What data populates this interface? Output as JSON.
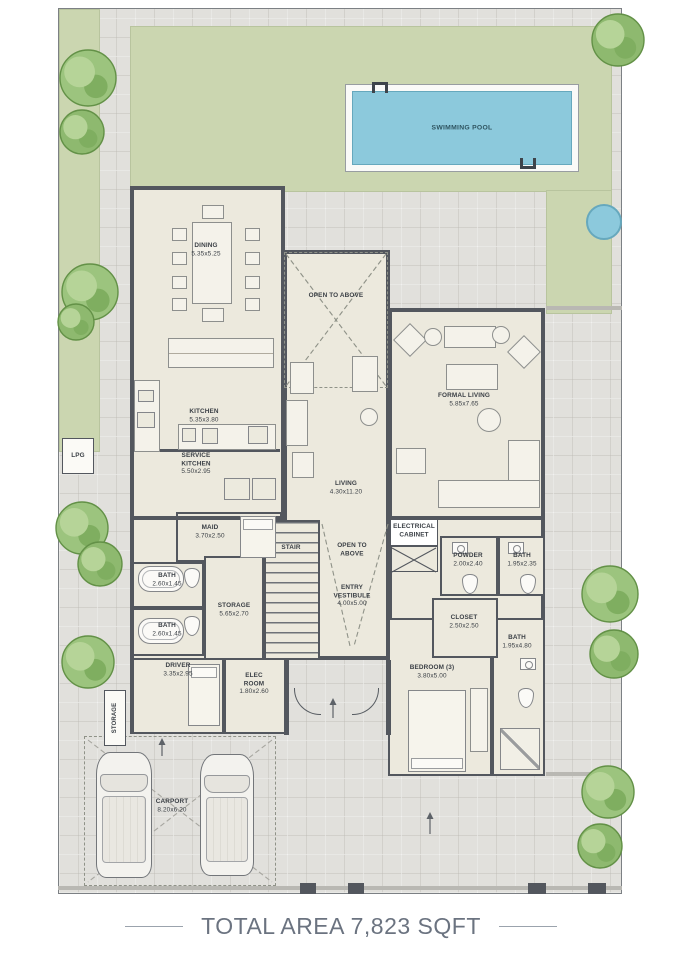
{
  "floorplan": {
    "pool_label": "SWIMMING POOL",
    "total_area_caption": "TOTAL AREA 7,823 SQFT",
    "rooms": [
      {
        "id": "dining",
        "name_lines": [
          "DINING"
        ],
        "dim": "5.35x5.25"
      },
      {
        "id": "kitchen",
        "name_lines": [
          "KITCHEN"
        ],
        "dim": "5.35x3.80"
      },
      {
        "id": "service_kitchen",
        "name_lines": [
          "SERVICE",
          "KITCHEN"
        ],
        "dim": "5.50x2.95"
      },
      {
        "id": "open_above_1",
        "name_lines": [
          "OPEN TO ABOVE"
        ],
        "dim": null
      },
      {
        "id": "living",
        "name_lines": [
          "LIVING"
        ],
        "dim": "4.30x11.20"
      },
      {
        "id": "formal_living",
        "name_lines": [
          "FORMAL LIVING"
        ],
        "dim": "5.85x7.65"
      },
      {
        "id": "maid",
        "name_lines": [
          "MAID"
        ],
        "dim": "3.70x2.50"
      },
      {
        "id": "bath_a",
        "name_lines": [
          "BATH"
        ],
        "dim": "2.60x1.45"
      },
      {
        "id": "bath_b",
        "name_lines": [
          "BATH"
        ],
        "dim": "2.60x1.45"
      },
      {
        "id": "storage",
        "name_lines": [
          "STORAGE"
        ],
        "dim": "5.65x2.70"
      },
      {
        "id": "driver",
        "name_lines": [
          "DRIVER"
        ],
        "dim": "3.35x2.95"
      },
      {
        "id": "elec_room",
        "name_lines": [
          "ELEC",
          "ROOM"
        ],
        "dim": "1.80x2.60"
      },
      {
        "id": "bedroom_3",
        "name_lines": [
          "BEDROOM (3)"
        ],
        "dim": "3.80x5.00"
      },
      {
        "id": "bath_d",
        "name_lines": [
          "BATH"
        ],
        "dim": "1.95x4.80"
      },
      {
        "id": "closet",
        "name_lines": [
          "CLOSET"
        ],
        "dim": "2.50x2.50"
      },
      {
        "id": "powder",
        "name_lines": [
          "POWDER"
        ],
        "dim": "2.00x2.40"
      },
      {
        "id": "bath_c",
        "name_lines": [
          "BATH"
        ],
        "dim": "1.95x2.35"
      },
      {
        "id": "electrical_cabinet",
        "name_lines": [
          "ELECTRICAL",
          "CABINET"
        ],
        "dim": null
      },
      {
        "id": "stair",
        "name_lines": [
          "STAIR"
        ],
        "dim": null
      },
      {
        "id": "open_above_2",
        "name_lines": [
          "OPEN TO",
          "ABOVE"
        ],
        "dim": null
      },
      {
        "id": "entry_vestibule",
        "name_lines": [
          "ENTRY",
          "VESTIBULE"
        ],
        "dim": "4.00x5.00"
      },
      {
        "id": "carport",
        "name_lines": [
          "CARPORT"
        ],
        "dim": "8.20x6.20"
      },
      {
        "id": "lpg",
        "name_lines": [
          "LPG"
        ],
        "dim": null
      },
      {
        "id": "storage_tag",
        "name_lines": [
          "STORAGE"
        ],
        "dim": null
      }
    ]
  }
}
